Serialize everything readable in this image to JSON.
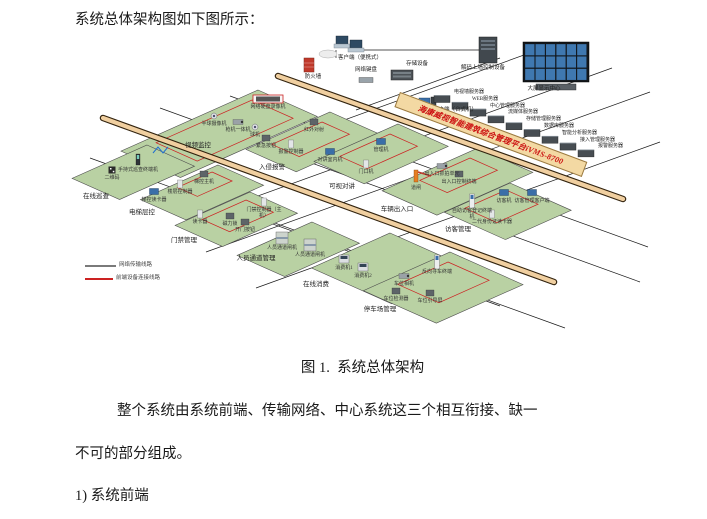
{
  "document": {
    "intro": "系统总体架构图如下图所示：",
    "caption": "图 1.  系统总体架构",
    "paragraph_line1": "整个系统由系统前端、传输网络、中心系统这三个相互衔接、缺一",
    "paragraph_line2": "不可的部分组成。",
    "list_item": "1) 系统前端"
  },
  "diagram": {
    "banner": {
      "text": "海康威视智能建筑综合管理平台iVMS-8700",
      "x": 400,
      "y": 92,
      "len": 198,
      "bg": "#f3d9a3",
      "text_color": "#cc1111"
    },
    "colors": {
      "platform_fill": "#b9d1a3",
      "platform_stroke": "#4d4d4d",
      "trunk_fill": "#f0cfa0",
      "trunk_edge": "#32230e",
      "grid_line": "#1a1a1a",
      "wire_red": "#cc2222",
      "legend_gray": "#7a7a7a"
    },
    "trunks": [
      [
        278,
        76,
        623,
        199
      ],
      [
        103,
        118,
        554,
        282
      ]
    ],
    "grid_lines": [
      [
        358,
        50,
        480,
        50
      ],
      [
        336,
        50,
        336,
        58
      ],
      [
        480,
        40,
        480,
        50
      ],
      [
        160,
        108,
        640,
        282
      ],
      [
        230,
        96,
        648,
        247
      ],
      [
        90,
        158,
        500,
        306
      ],
      [
        250,
        214,
        565,
        328
      ],
      [
        560,
        42,
        278,
        144
      ],
      [
        612,
        68,
        208,
        214
      ],
      [
        650,
        92,
        206,
        252
      ],
      [
        660,
        142,
        256,
        288
      ],
      [
        500,
        58,
        356,
        110
      ]
    ],
    "legend": {
      "items": [
        {
          "label": "网络传输线路",
          "color": "#7a7a7a",
          "x1": 85,
          "y1": 266,
          "x2": 116,
          "y2": 266
        },
        {
          "label": "前端设备连接线路",
          "color": "#cc2222",
          "x1": 85,
          "y1": 279,
          "x2": 113,
          "y2": 279
        }
      ]
    },
    "top_devices": [
      {
        "t": "firewall",
        "l": "防火墙",
        "x": 309,
        "y": 66,
        "lx": 313,
        "ly": 75
      },
      {
        "t": "laptops",
        "l": "客户端（便携式）",
        "x": 338,
        "y": 44,
        "lx": 360,
        "ly": 56
      },
      {
        "t": "keyboard",
        "l": "网络键盘",
        "x": 366,
        "y": 80,
        "lx": 366,
        "ly": 68
      },
      {
        "t": "storage",
        "l": "存储设备",
        "x": 402,
        "y": 75,
        "lx": 417,
        "ly": 62
      },
      {
        "t": "server-tall",
        "l": "解码上墙控制设备",
        "x": 488,
        "y": 50,
        "lx": 483,
        "ly": 66
      },
      {
        "t": "videowall",
        "l": "大屏显示中心",
        "x": 556,
        "y": 62,
        "lx": 544,
        "ly": 87
      },
      {
        "t": "desktop",
        "l": "客户端（台式机）",
        "x": 426,
        "y": 103,
        "lx": 455,
        "ly": 108
      }
    ],
    "servers": {
      "x0": 442,
      "y0": 99,
      "dx": 18,
      "dy": 6.8,
      "labels": [
        "电视墙服务器",
        "WEB服务器",
        "中心管理服务器",
        "流媒体服务器",
        "存储管理服务器",
        "数据库服务器",
        "智能分析服务器",
        "接入管理服务器",
        "报警服务器"
      ]
    },
    "platforms": [
      {
        "label": "视频监控",
        "lx": 198,
        "ly": 143,
        "tx": 258,
        "ty": 90,
        "a": 65,
        "b": 150,
        "red": [
          252,
          100,
          45,
          105
        ],
        "devices": [
          {
            "t": "nvr",
            "l": "网络硬盘录像机",
            "x": 268,
            "y": 99
          },
          {
            "t": "dome",
            "l": "半球摄像机",
            "x": 214,
            "y": 116
          },
          {
            "t": "cam",
            "l": "枪机一体机",
            "x": 238,
            "y": 122
          },
          {
            "t": "dome",
            "l": "球机",
            "x": 255,
            "y": 127
          }
        ]
      },
      {
        "label": "在线巡查",
        "lx": 96,
        "ly": 194,
        "tx": 147,
        "ty": 145,
        "a": 52,
        "b": 82,
        "devices": [
          {
            "t": "wifi",
            "l": "",
            "x": 158,
            "y": 150
          },
          {
            "t": "handheld",
            "l": "手持式巡查终端机",
            "x": 138,
            "y": 162
          },
          {
            "t": "qr",
            "l": "二维码",
            "x": 112,
            "y": 170
          }
        ]
      },
      {
        "label": "电梯层控",
        "lx": 142,
        "ly": 210,
        "tx": 218,
        "ty": 165,
        "a": 50,
        "b": 85,
        "red": [
          212,
          172,
          22,
          38
        ],
        "devices": [
          {
            "t": "box",
            "l": "梯控主机",
            "x": 204,
            "y": 174
          },
          {
            "t": "panel",
            "l": "楼层控制器",
            "x": 180,
            "y": 184
          },
          {
            "t": "screen",
            "l": "梯控读卡器",
            "x": 154,
            "y": 192
          }
        ]
      },
      {
        "label": "门禁管理",
        "lx": 184,
        "ly": 238,
        "tx": 250,
        "ty": 192,
        "a": 52,
        "b": 82,
        "red": [
          246,
          200,
          30,
          48
        ],
        "devices": [
          {
            "t": "panel",
            "l": "门禁控制器（主机）",
            "x": 264,
            "y": 202
          },
          {
            "t": "panel",
            "l": "读卡器",
            "x": 200,
            "y": 214
          },
          {
            "t": "box",
            "l": "磁力锁",
            "x": 230,
            "y": 216
          },
          {
            "t": "box",
            "l": "开门按钮",
            "x": 245,
            "y": 222
          }
        ]
      },
      {
        "label": "人员通道管理",
        "lx": 256,
        "ly": 256,
        "tx": 312,
        "ty": 222,
        "a": 52,
        "b": 82,
        "devices": [
          {
            "t": "gate",
            "l": "人员通道闸机",
            "x": 282,
            "y": 240
          },
          {
            "t": "gate",
            "l": "人员通道闸机",
            "x": 310,
            "y": 247
          }
        ]
      },
      {
        "label": "入侵报警",
        "lx": 272,
        "ly": 165,
        "tx": 330,
        "ty": 112,
        "a": 55,
        "b": 92,
        "red": [
          322,
          122,
          30,
          55
        ],
        "devices": [
          {
            "t": "box",
            "l": "红外对射",
            "x": 314,
            "y": 122
          },
          {
            "t": "box",
            "l": "紧急按钮",
            "x": 266,
            "y": 138
          },
          {
            "t": "panel",
            "l": "报警控制器",
            "x": 291,
            "y": 144
          }
        ]
      },
      {
        "label": "可视对讲",
        "lx": 342,
        "ly": 184,
        "tx": 398,
        "ty": 124,
        "a": 55,
        "b": 92,
        "red": [
          390,
          134,
          30,
          55
        ],
        "devices": [
          {
            "t": "screen",
            "l": "管理机",
            "x": 381,
            "y": 142
          },
          {
            "t": "screen",
            "l": "对讲室内机",
            "x": 330,
            "y": 152
          },
          {
            "t": "panel",
            "l": "门口机",
            "x": 366,
            "y": 164
          }
        ]
      },
      {
        "label": "车辆出入口",
        "lx": 397,
        "ly": 207,
        "tx": 478,
        "ty": 148,
        "a": 60,
        "b": 105,
        "red": [
          470,
          158,
          30,
          55
        ],
        "devices": [
          {
            "t": "cam",
            "l": "出入口抓拍单元",
            "x": 442,
            "y": 166
          },
          {
            "t": "barrier",
            "l": "道闸",
            "x": 416,
            "y": 180
          },
          {
            "t": "box",
            "l": "出入口控制终端",
            "x": 459,
            "y": 174
          }
        ]
      },
      {
        "label": "访客管理",
        "lx": 458,
        "ly": 227,
        "tx": 510,
        "ty": 183,
        "a": 67,
        "b": 72,
        "red": [
          506,
          190,
          35,
          45
        ],
        "devices": [
          {
            "t": "kiosk",
            "l": "自助访客登记终端机",
            "x": 472,
            "y": 203
          },
          {
            "t": "screen",
            "l": "访客机",
            "x": 504,
            "y": 193
          },
          {
            "t": "screen",
            "l": "访客管理客户端",
            "x": 532,
            "y": 193
          },
          {
            "t": "panel",
            "l": "二代身份证读卡器",
            "x": 492,
            "y": 214
          }
        ]
      },
      {
        "label": "在线消费",
        "lx": 316,
        "ly": 282,
        "tx": 390,
        "ty": 233,
        "a": 88,
        "b": 86,
        "devices": [
          {
            "t": "pos",
            "l": "消费机1",
            "x": 344,
            "y": 260
          },
          {
            "t": "pos",
            "l": "消费机2",
            "x": 363,
            "y": 268
          }
        ]
      },
      {
        "label": "停车场管理",
        "lx": 380,
        "ly": 307,
        "tx": 450,
        "ty": 252,
        "a": 80,
        "b": 95,
        "red": [
          448,
          262,
          45,
          55
        ],
        "devices": [
          {
            "t": "cam",
            "l": "车位相机",
            "x": 404,
            "y": 276
          },
          {
            "t": "box",
            "l": "车位检测器",
            "x": 396,
            "y": 291
          },
          {
            "t": "kiosk",
            "l": "反向寻车终端",
            "x": 437,
            "y": 264
          },
          {
            "t": "box",
            "l": "车位引导屏",
            "x": 430,
            "y": 293
          }
        ]
      }
    ]
  }
}
